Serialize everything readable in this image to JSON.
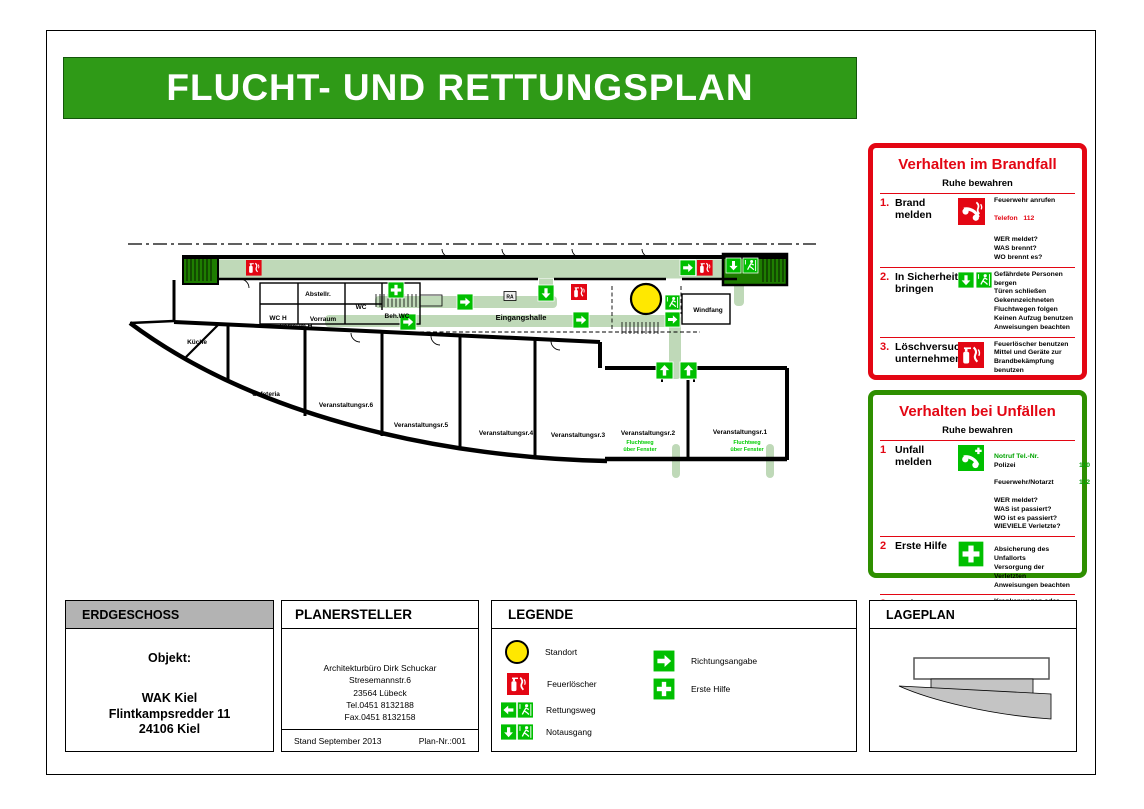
{
  "title": "FLUCHT- UND RETTUNGSPLAN",
  "colors": {
    "title_bar_green": "#2f9a17",
    "safety_green": "#00bf00",
    "stair_green": "#1e7d00",
    "route_green": "#bfd9b8",
    "alarm_red": "#e30613",
    "header_gray": "#b3b3b3",
    "standort_yellow": "#ffe800"
  },
  "brandfall": {
    "title": "Verhalten im Brandfall",
    "subtitle": "Ruhe bewahren",
    "items": [
      {
        "num": "1.",
        "title": "Brand melden",
        "icon": "phone-fire-icon",
        "line1": "Feuerwehr anrufen",
        "phone_label": "Telefon",
        "phone_number": "112",
        "details": "WER meldet?\nWAS brennt?\nWO brennt es?"
      },
      {
        "num": "2.",
        "title": "In Sicherheit bringen",
        "icon": "notausgang-icon",
        "details": "Gefährdete Personen\nbergen\nTüren schließen\nGekennzeichneten\nFluchtwegen folgen\nKeinen Aufzug benutzen\nAnweisungen beachten"
      },
      {
        "num": "3.",
        "title": "Löschversuch unternehmen",
        "icon": "extinguisher-icon",
        "details": "Feuerlöscher benutzen\nMittel und Geräte zur\nBrandbekämpfung\nbenutzen"
      }
    ]
  },
  "unfaelle": {
    "title": "Verhalten bei Unfällen",
    "subtitle": "Ruhe bewahren",
    "items": [
      {
        "num": "1",
        "title": "Unfall melden",
        "icon": "phone-green-icon",
        "notruf_label": "Notruf Tel.-Nr.",
        "numbers": [
          {
            "name": "Polizei",
            "value": "110"
          },
          {
            "name": "Feuerwehr/Notarzt",
            "value": "112"
          }
        ],
        "details": "WER meldet?\nWAS ist passiert?\nWO ist es passiert?\nWIEVIELE Verletzte?"
      },
      {
        "num": "2",
        "title": "Erste Hilfe",
        "icon": "first-aid-icon",
        "details": "Absicherung des Unfallorts\nVersorgung der Verletzten\nAnweisungen beachten"
      },
      {
        "num": "3",
        "title": "Weitere Maßnahmen",
        "icon": "",
        "details": "Krankenwagen oder\nFeuerwehr einweisen\nSchaulustige entfernen"
      }
    ]
  },
  "erdgeschoss": {
    "header": "ERDGESCHOSS",
    "object_label": "Objekt:",
    "address": "WAK Kiel\nFlintkampsredder 11\n24106 Kiel"
  },
  "planersteller": {
    "header": "PLANERSTELLER",
    "address": "Architekturbüro Dirk Schuckar\nStresemannstr.6\n23564 Lübeck\nTel.0451 8132188\nFax.0451 8132158",
    "stand": "Stand September 2013",
    "plan_nr": "Plan-Nr.:001"
  },
  "legende": {
    "header": "LEGENDE",
    "items_left": [
      {
        "icon": "standort-icon",
        "label": "Standort"
      },
      {
        "icon": "extinguisher-icon",
        "label": "Feuerlöscher"
      },
      {
        "icon": "rettungsweg-icon",
        "label": "Rettungsweg"
      },
      {
        "icon": "notausgang-icon",
        "label": "Notausgang"
      }
    ],
    "items_right": [
      {
        "icon": "richtung-icon",
        "label": "Richtungsangabe"
      },
      {
        "icon": "erste-hilfe-icon",
        "label": "Erste Hilfe"
      }
    ]
  },
  "lageplan": {
    "header": "LAGEPLAN"
  },
  "plan": {
    "rooms": {
      "kueche": "Küche",
      "cafeteria": "Cafeteria",
      "v6": "Veranstaltungsr.6",
      "v5": "Veranstaltungsr.5",
      "v4": "Veranstaltungsr.4",
      "v3": "Veranstaltungsr.3",
      "v2": "Veranstaltungsr.2",
      "v1": "Veranstaltungsr.1",
      "abstellr": "Abstellr.",
      "wc": "WC",
      "wc_h": "WC H",
      "vorraum": "Vorraum",
      "vorraum_h": "Vorraum H",
      "beh_wc": "Beh.WC",
      "eingangshalle": "Eingangshalle",
      "windfang": "Windfang"
    },
    "ra_label": "RA",
    "fluchtweg_line1": "Fluchtweg",
    "fluchtweg_line2": "über Fenster"
  }
}
